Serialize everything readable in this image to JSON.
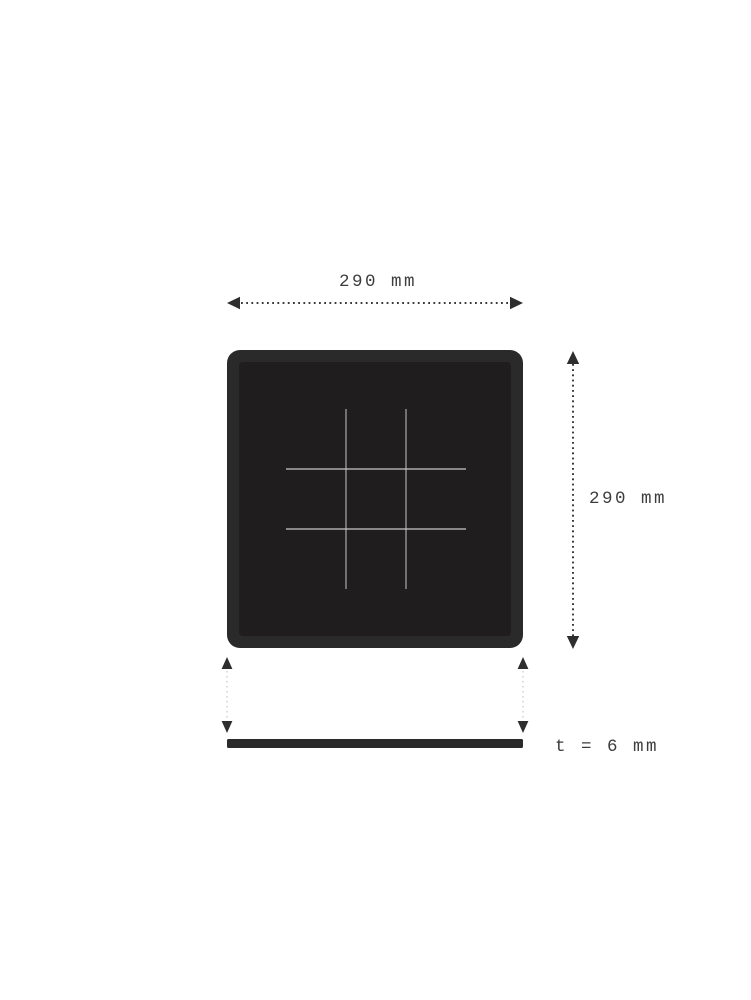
{
  "drawing": {
    "type": "technical-drawing",
    "subject": "square chalkboard with tic-tac-toe grid, front view and side (thickness) view",
    "top_dimension": {
      "label": "290 mm",
      "value_mm": 290,
      "axis": "width"
    },
    "right_dimension": {
      "label": "290 mm",
      "value_mm": 290,
      "axis": "height"
    },
    "thickness_dimension": {
      "label": "t = 6 mm",
      "value_mm": 6,
      "axis": "thickness"
    }
  },
  "icons": {
    "arrowhead": "solid triangle arrowhead on dotted dimension line"
  },
  "colors": {
    "background": "#ffffff",
    "board_frame": "#2b2a2a",
    "board_surface": "#1f1d1d",
    "grid_line_horizontal": "#c8c8c8",
    "grid_line_vertical": "#9f9f9f",
    "dimension_line": "#3a3a3a",
    "arrowhead": "#2f2e2e",
    "projection_line": "#c6c6c6",
    "label_text": "#3d3d3d",
    "thickness_bar": "#2b2a2a"
  }
}
